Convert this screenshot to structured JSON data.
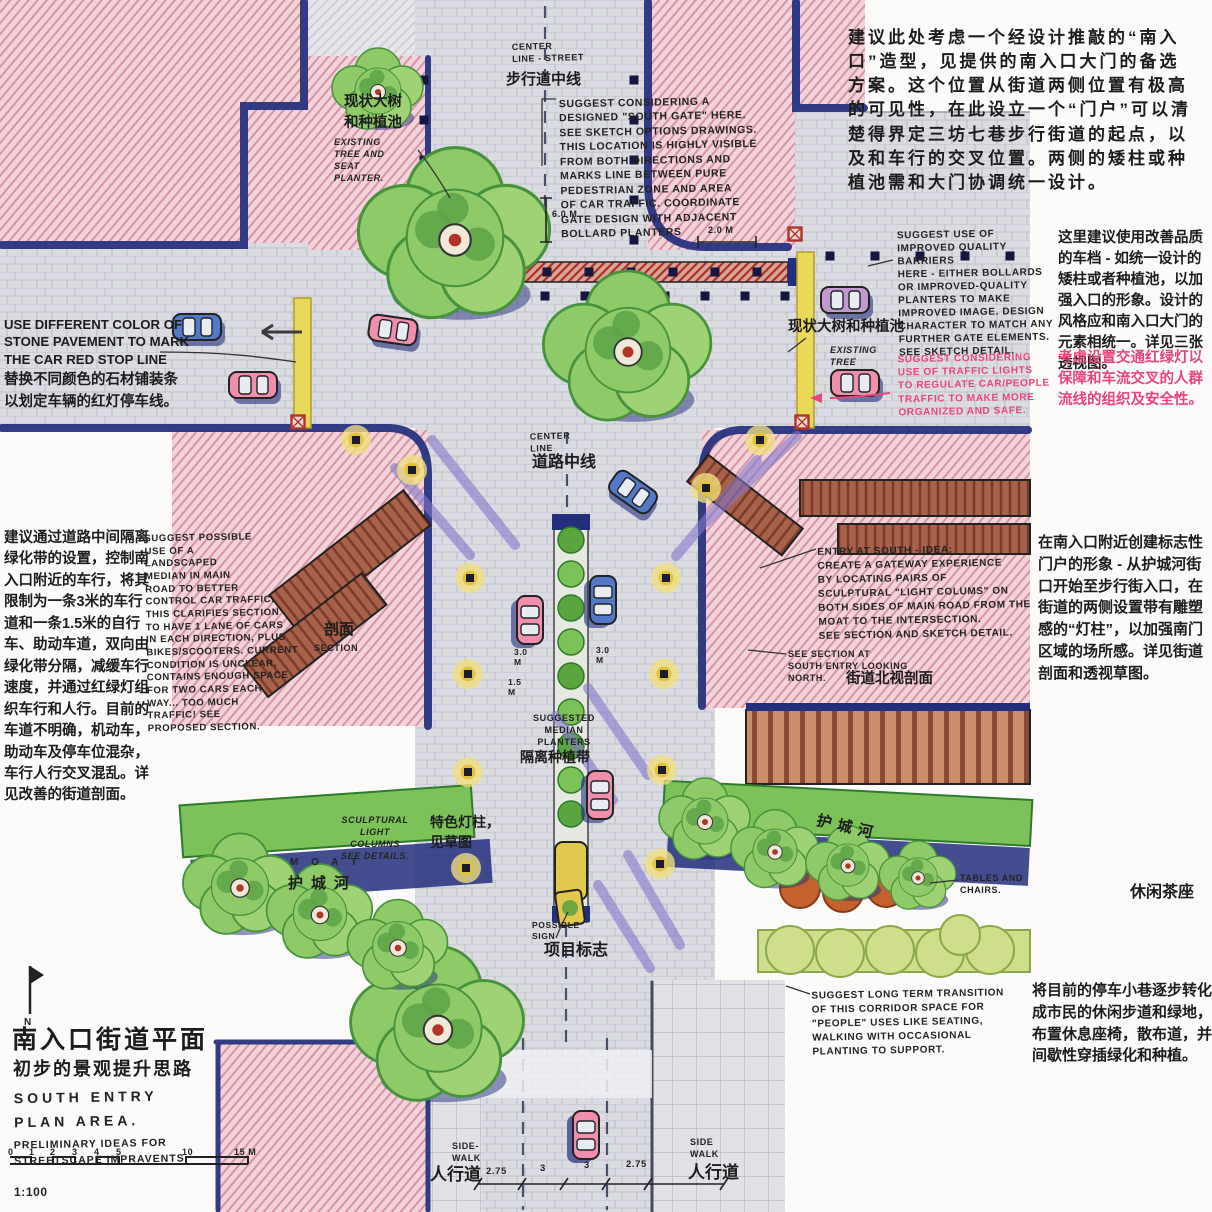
{
  "colors": {
    "paper": "#fcfbf9",
    "block_pink": "#f2d3d9",
    "hatch_pink": "#d694a4",
    "navy": "#232e7d",
    "street_gray": "#dbdce2",
    "tree_green": "#8fca68",
    "hedge_green": "#7cc258",
    "bush_light_green": "#cede8a",
    "lantern_yellow": "#f1e07e",
    "curb_yellow": "#e9d959",
    "gate_red": "#a8321f",
    "streak_purple": "#8478cb",
    "accent_pink_text": "#e8457a",
    "roof_brown": "#a8614a",
    "ink": "#1c1c1c"
  },
  "texts": {
    "title_cn": "南入口街道平面",
    "subtitle_cn": "初步的景观提升思路",
    "title_en_a": "SOUTH ENTRY\nPLAN AREA.",
    "title_en_b": "PRELIMINARY IDEAS FOR\nSTREETSCAPE IMPRAVENTS.",
    "scale_ratio": "1:100",
    "scale_ticks": [
      "0",
      "1",
      "2",
      "3",
      "4",
      "5",
      "10",
      "15 M"
    ],
    "north_label": "N",
    "existing_tree_tl_cn": "现状大树\n和种植池",
    "existing_tree_tl_en": "EXISTING\nTREE AND\nSEAT\nPLANTER.",
    "centerline_ped_en": "CENTER\nLINE - STREET",
    "centerline_ped_cn": "步行道中线",
    "south_gate_en": "SUGGEST CONSIDERING A\nDESIGNED \"SOUTH GATE\" HERE.\nSEE SKETCH OPTIONS DRAWINGS.\nTHIS LOCATION IS HIGHLY VISIBLE\nFROM BOTH DIRECTIONS AND\nMARKS LINE BETWEEN PURE\nPEDESTRIAN ZONE AND AREA\nOF CAR TRAFFIC. COORDINATE\nGATE DESIGN WITH ADJACENT\nBOLLARD PLANTERS",
    "south_gate_cn": "建议此处考虑一个经设计推敲的“南入口”造型，见提供的南入口大门的备选方案。这个位置从街道两侧位置有极高的可见性，在此设立一个“门户”可以清楚得界定三坊七巷步行街道的起点，以及和车行的交叉位置。两侧的矮柱或种植池需和大门协调统一设计。",
    "dim_6m": "6.0 M",
    "dim_2m": "2.0 m",
    "barriers_en": "SUGGEST USE OF\nIMPROVED QUALITY\nBARRIERS\nHERE - EITHER BOLLARDS\nOR IMPROVED-QUALITY\nPLANTERS TO MAKE\nIMPROVED IMAGE. DESIGN\nCHARACTER TO MATCH ANY\nFURTHER GATE ELEMENTS.\nSEE SKETCH DETAIL.",
    "barriers_cn": "这里建议使用改善品质的车档 - 如统一设计的矮柱或者种植池，以加强入口的形象。设计的风格应和南入口大门的元素相统一。详见三张透视图。",
    "traffic_lights_en": "SUGGEST CONSIDERING\nUSE OF TRAFFIC LIGHTS\nTO REGULATE CAR/PEOPLE\nTRAFFIC TO MAKE MORE\nORGANIZED AND SAFE.",
    "traffic_lights_cn": "考虑设置交通红绿灯以保障和车流交叉的人群流线的组织及安全性。",
    "existing_tree_r_cn": "现状大树和种植池",
    "existing_tree_r_en": "EXISTING\nTREE",
    "stop_line_en": "USE DIFFERENT COLOR OF\nSTONE PAVEMENT TO MARK\nTHE CAR RED STOP LINE",
    "stop_line_cn": "替换不同颜色的石材铺装条\n以划定车辆的红灯停车线。",
    "centerline_road_en": "CENTER\nLINE",
    "centerline_road_cn": "道路中线",
    "median_cn": "建议通过道路中间隔离绿化带的设置，控制南入口附近的车行，将其限制为一条3米的车行道和一条1.5米的自行车、助动车道，双向由绿化带分隔，减缓车行速度，并通过红绿灯组织车行和人行。目前的车道不明确，机动车，助动车及停车位混杂，车行人行交叉混乱。详见改善的街道剖面。",
    "median_en": "SUGGEST POSSIBLE\nUSE OF A\nLANDSCAPED\nMEDIAN IN MAIN\nROAD TO BETTER\nCONTROL CAR TRAFFIC.\nTHIS CLARIFIES SECTION\nTO HAVE 1 LANE OF CARS\nIN EACH DIRECTION, PLUS\nBIKES/SCOOTERS. CURRENT\nCONDITION IS UNCLEAR,\nCONTAINS ENOUGH SPACE\nFOR TWO CARS EACH\nWAY... TOO MUCH\nTRAFFIC! SEE\nPROPOSED SECTION.",
    "section_cn": "剖面",
    "section_en": "SECTION",
    "entry_south_en": "ENTRY AT SOUTH - IDEA:\nCREATE A GATEWAY EXPERIENCE\nBY LOCATING PAIRS OF\nSCULPTURAL \"LIGHT COLUMS\" ON\nBOTH SIDES OF MAIN ROAD FROM THE\nMOAT TO THE INTERSECTION.\nSEE SECTION AND SKETCH DETAIL.",
    "see_section_en": "SEE SECTION AT\nSOUTH ENTRY LOOKING\nNORTH.",
    "see_section_cn": "街道北视剖面",
    "gateway_cn": "在南入口附近创建标志性门户的形象 - 从护城河街口开始至步行街入口，在街道的两侧设置带有雕塑感的“灯柱”，以加强南门区域的场所感。详见街道剖面和透视草图。",
    "median_planters_en": "SUGGESTED\nMEDIAN\nPLANTERS",
    "median_planters_cn": "隔离种植带",
    "dim_3m_a": "3.0\nM",
    "dim_3m_b": "3.0\nM",
    "dim_15m": "1.5\nM",
    "sculpt_columns_en": "SCULPTURAL\nLIGHT\nCOLUMNS\nSEE DETAILS.",
    "moat_en": "M O A T",
    "moat_cn": "护城河",
    "moat_r_cn": "护城河",
    "light_column_cn": "特色灯柱，\n见草图",
    "tables_en": "TABLES AND\nCHAIRS.",
    "tea_cn": "休闲茶座",
    "sign_en": "POSSIBLE\nSIGN",
    "sign_cn": "项目标志",
    "transition_en": "SUGGEST LONG TERM TRANSITION\nOF THIS CORRIDOR SPACE FOR\n\"PEOPLE\" USES LIKE SEATING,\nWALKING WITH OCCASIONAL\nPLANTING TO SUPPORT.",
    "transition_cn": "将目前的停车小巷逐步转化成市民的休闲步道和绿地，布置休息座椅，散布道，并间歇性穿插绿化和种植。",
    "sidewalk_l_en": "SIDE-\nWALK",
    "sidewalk_l_cn": "人行道",
    "sidewalk_r_en": "SIDE\nWALK",
    "sidewalk_r_cn": "人行道",
    "dim_275_a": "2.75",
    "dim_3_a": "3",
    "dim_3_b": "3",
    "dim_275_b": "2.75"
  }
}
